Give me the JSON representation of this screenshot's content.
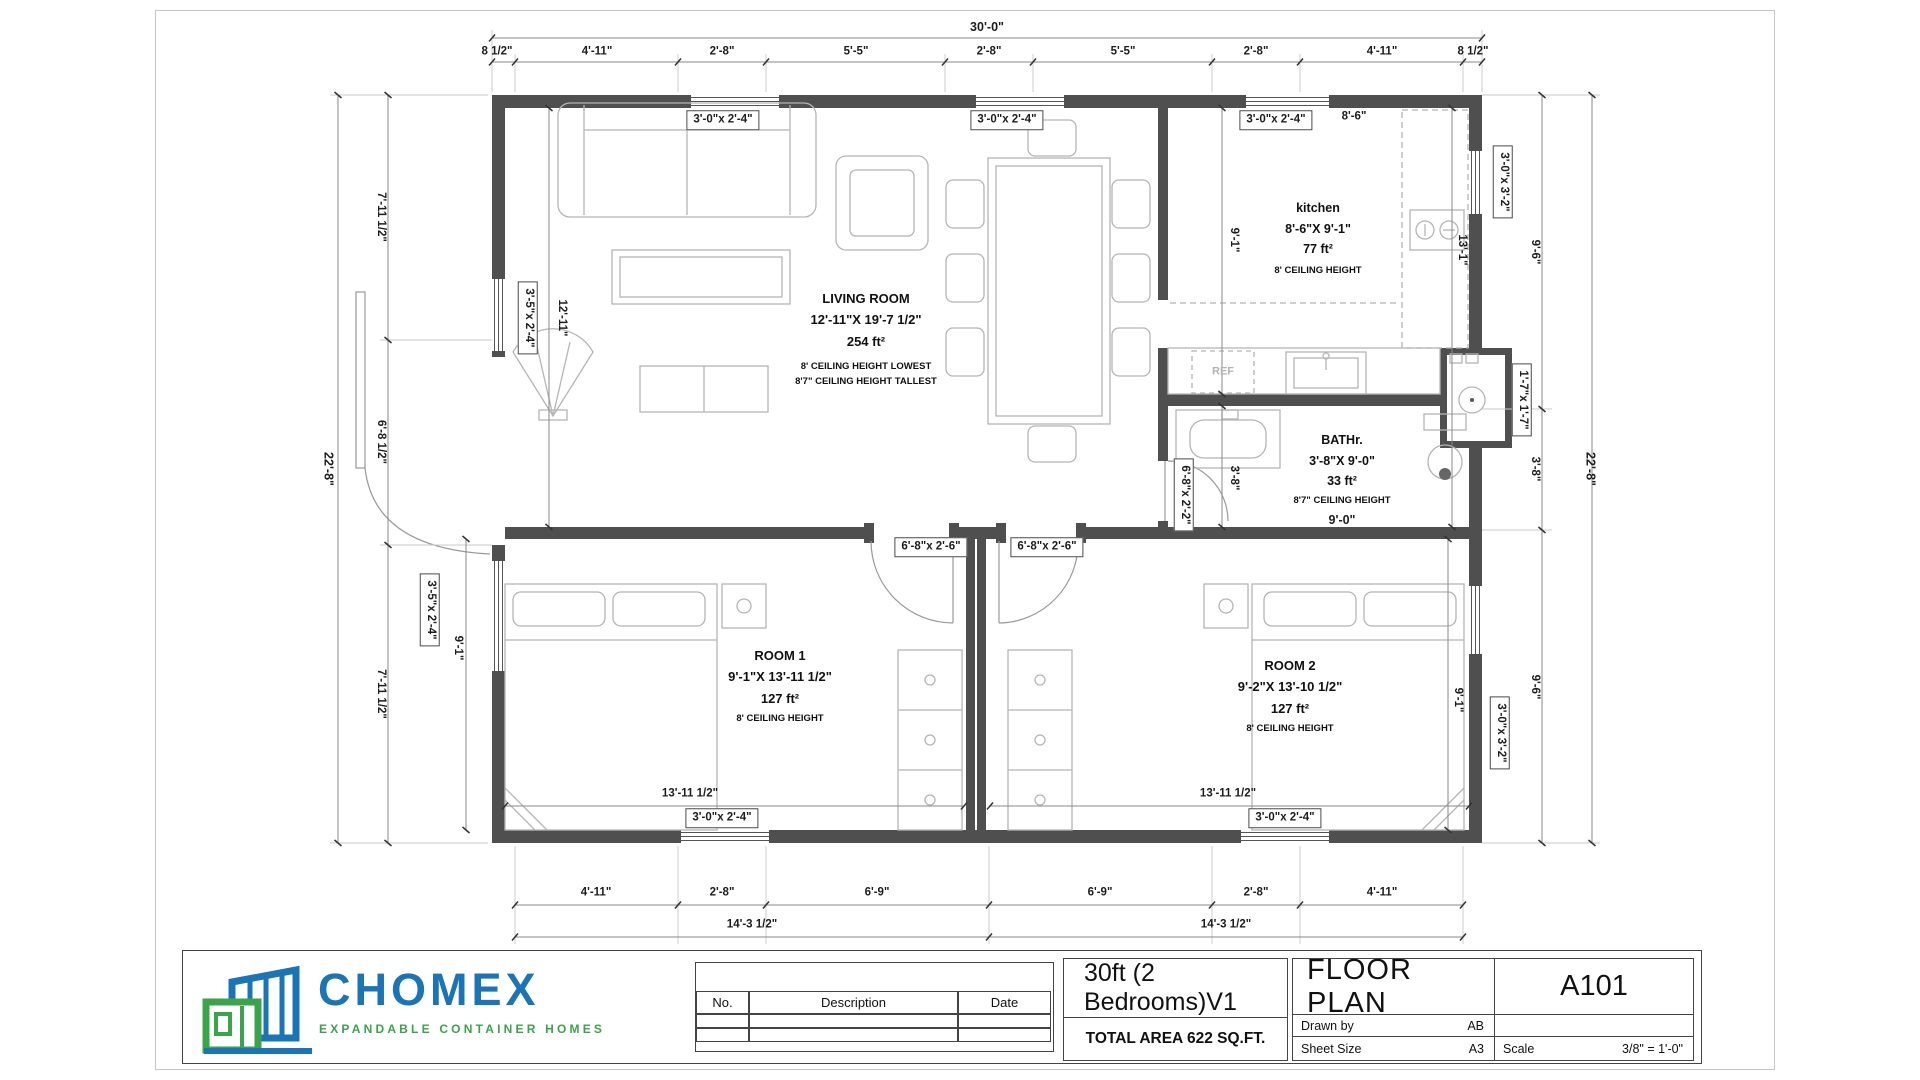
{
  "logo": {
    "name": "CHOMEX",
    "tagline": "EXPANDABLE CONTAINER HOMES",
    "blue": "#1b74b5",
    "green": "#3ba44a"
  },
  "title_block": {
    "revision_table": {
      "no": "No.",
      "description": "Description",
      "date": "Date"
    },
    "project_title": "30ft (2 Bedrooms)V1",
    "total_area": "TOTAL AREA 622 SQ.FT.",
    "sheet_title": "FLOOR PLAN",
    "sheet_number": "A101",
    "drawn_by_label": "Drawn by",
    "drawn_by_value": "AB",
    "sheet_size_label": "Sheet Size",
    "sheet_size_value": "A3",
    "scale_label": "Scale",
    "scale_value": "3/8\" = 1'-0\""
  },
  "rooms": {
    "living": {
      "name": "LIVING ROOM",
      "size": "12'-11\"X 19'-7 1/2\"",
      "area": "254 ft²",
      "note1": "8' CEILING HEIGHT LOWEST",
      "note2": "8'7\" CEILING HEIGHT TALLEST"
    },
    "kitchen": {
      "name": "kitchen",
      "size": "8'-6\"X 9'-1\"",
      "area": "77 ft²",
      "note": "8' CEILING HEIGHT"
    },
    "bath": {
      "name": "BATHr.",
      "size": "3'-8\"X 9'-0\"",
      "area": "33 ft²",
      "note": "8'7\" CEILING HEIGHT",
      "width_dim": "9'-0\""
    },
    "room1": {
      "name": "ROOM 1",
      "size": "9'-1\"X 13'-11 1/2\"",
      "area": "127 ft²",
      "note": "8' CEILING HEIGHT"
    },
    "room2": {
      "name": "ROOM 2",
      "size": "9'-2\"X 13'-10 1/2\"",
      "area": "127 ft²",
      "note": "8' CEILING HEIGHT"
    },
    "ref_label": "REF"
  },
  "openings": {
    "window_30x24": "3'-0\"x 2'-4\"",
    "window_35x24": "3'-5\"x 2'-4\"",
    "window_30x32": "3'-0\"x 3'-2\"",
    "shower_17x17": "1'-7\"x 1'-7\"",
    "door_68x26": "6'-8\"x 2'-6\"",
    "door_68x22": "6'-8\"x 2'-2\""
  },
  "dimensions": {
    "top_overall": "30'-0\"",
    "top": [
      "8 1/2\"",
      "4'-11\"",
      "2'-8\"",
      "5'-5\"",
      "2'-8\"",
      "5'-5\"",
      "2'-8\"",
      "4'-11\"",
      "8 1/2\""
    ],
    "bottom": [
      "4'-11\"",
      "2'-8\"",
      "6'-9\"",
      "6'-9\"",
      "2'-8\"",
      "4'-11\""
    ],
    "bottom_mid": [
      "14'-3 1/2\"",
      "14'-3 1/2\""
    ],
    "left_overall": "22'-8\"",
    "left": [
      "7'-11 1/2\"",
      "6'-8 1/2\"",
      "7'-11 1/2\""
    ],
    "right_overall": "22'-8\"",
    "right": [
      "9'-6\"",
      "3'-8\"",
      "9'-6\""
    ],
    "living_height": "12'-11\"",
    "kitchen_width": "8'-6\"",
    "kitchen_depth": "9'-1\"",
    "kitchen_right": "13'-1\"",
    "bath_depth": "3'-8\"",
    "room1_width": "13'-11 1/2\"",
    "room2_width": "13'-11 1/2\"",
    "room1_depth": "9'-1\"",
    "room2_depth": "9'-1\""
  }
}
